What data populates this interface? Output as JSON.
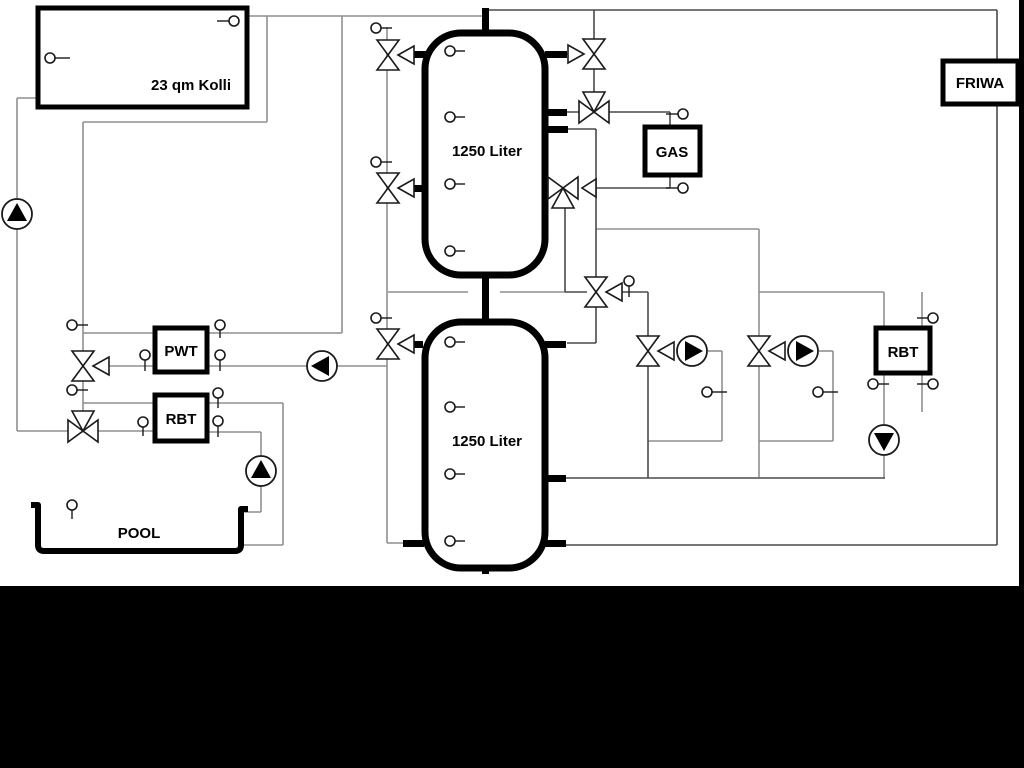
{
  "labels": {
    "collector": "23 qm Kolli",
    "tank_top": "1250 Liter",
    "tank_bottom": "1250 Liter",
    "pwt": "PWT",
    "rbt_left": "RBT",
    "pool": "POOL",
    "gas": "GAS",
    "friwa": "FRIWA",
    "rbt_right": "RBT"
  },
  "icons": {
    "pump": "pump-icon",
    "three_way_valve": "three-way-valve-icon",
    "temperature_sensor": "temperature-sensor-icon"
  },
  "colors": {
    "line_light": "#8f8f8f",
    "line_dark": "#4a4a4a",
    "component": "#000000",
    "background": "#ffffff",
    "band": "#000000"
  }
}
